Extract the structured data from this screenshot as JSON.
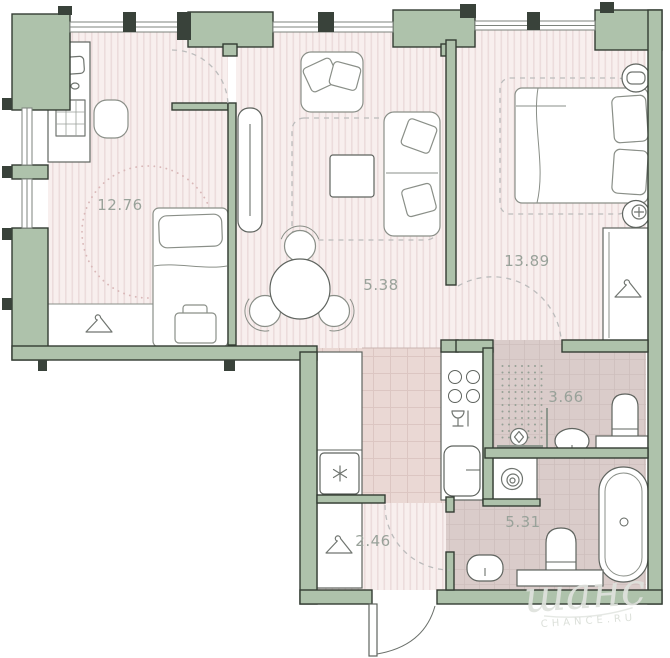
{
  "page": {
    "background": "#ffffff"
  },
  "areas": {
    "room1": "12.76",
    "living": "5.38",
    "bedroom": "13.89",
    "bath_small": "3.66",
    "hall": "2.46",
    "bath_large": "5.31"
  },
  "watermark": {
    "logo": "шанс",
    "site": "CHANCE.RU"
  },
  "colors": {
    "wall_fill": "#aec2ab",
    "wall_outline": "#333c33",
    "floor_stripe_base": "#f8efee",
    "floor_stripe_line": "#ecdcdc",
    "kitchen_tile_base": "#ead8d4",
    "kitchen_tile_line": "#dcc6c2",
    "bath_floor_base": "#daccca",
    "bath_floor_line": "#cebfbd",
    "furniture_outline": "#5f645f",
    "soft_furniture_outline": "#8a8f88",
    "dash_line": "#bcbcbc",
    "clearance_dotted": "#d9b8b8",
    "label_text": "#99a29a",
    "watermark_text": "#dfe2dd"
  }
}
